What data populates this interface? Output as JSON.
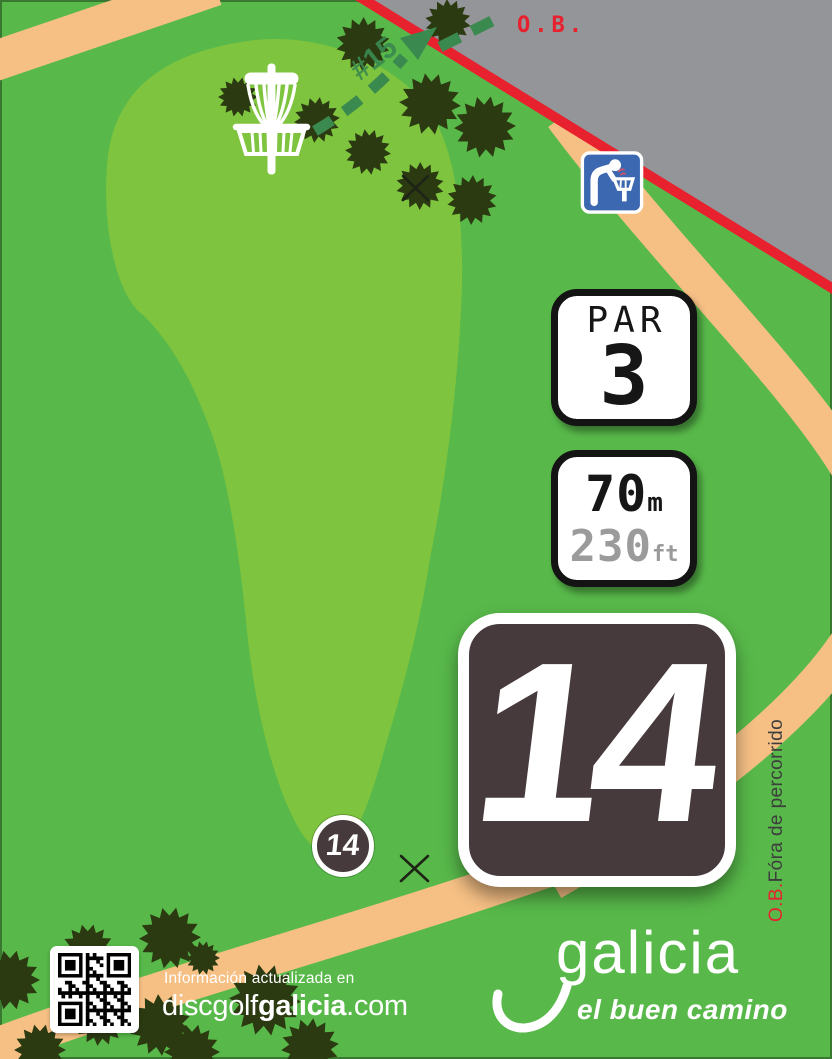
{
  "colors": {
    "background_green": "#58b94a",
    "fairway_green": "#7ec43e",
    "path_orange": "#f6c085",
    "road_gray": "#939598",
    "ob_red": "#e8212e",
    "tree_green": "#2c3a12",
    "arrow_green": "#3a8a4f",
    "badge_dark": "#473a3d",
    "sign_blue": "#3b68b1",
    "feet_gray": "#9b9b9b"
  },
  "map": {
    "ob_label": "O.B.",
    "next_hole_label": "#15",
    "side_label": {
      "prefix": "O.B.",
      "text": "Fóra de percorrido"
    },
    "tee_number": "14"
  },
  "badges": {
    "par": {
      "label": "PAR",
      "value": "3"
    },
    "distance": {
      "meters_value": "70",
      "meters_unit": "m",
      "feet_value": "230",
      "feet_unit": "ft"
    },
    "hole_number": "14"
  },
  "footer": {
    "info_text": "Información actualizada en",
    "url": {
      "prefix": "discgolf",
      "bold": "galicia",
      "suffix": ".com"
    }
  },
  "logo": {
    "wordmark": "galicia",
    "tagline": "el buen camino"
  },
  "icons": {
    "basket": "disc-golf-basket",
    "sign": "drinking-fountain-sign",
    "qr": "qr-code",
    "tree": "tree",
    "x": "x-mark",
    "arrow": "flight-path-arrow"
  }
}
